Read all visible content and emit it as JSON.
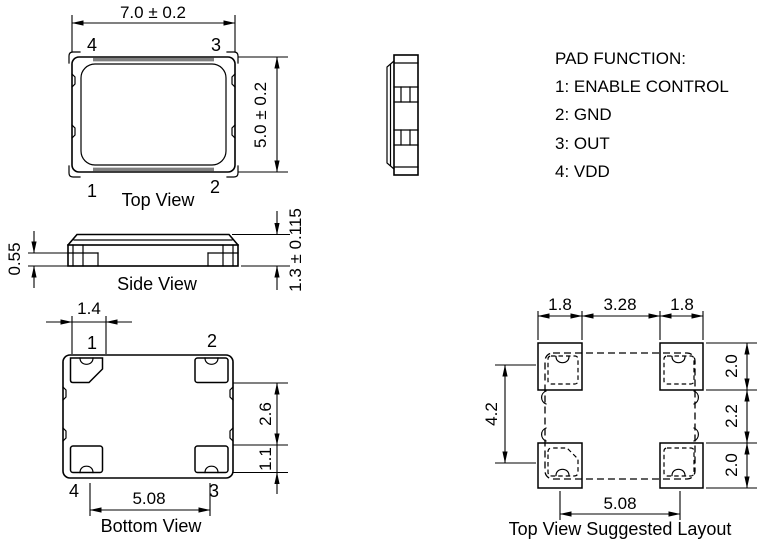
{
  "drawing": {
    "top_view": {
      "title": "Top View",
      "dim_width": "7.0 ± 0.2",
      "dim_height": "5.0 ± 0.2",
      "pin1": "1",
      "pin2": "2",
      "pin3": "3",
      "pin4": "4"
    },
    "side_view": {
      "title": "Side View",
      "dim_seat_height": "0.55",
      "dim_total_height": "1.3 ± 0.115"
    },
    "bottom_view": {
      "title": "Bottom View",
      "dim_pad_width": "1.4",
      "dim_edge_upper": "2.6",
      "dim_edge_lower": "1.1",
      "dim_pad_pitch": "5.08",
      "pin1": "1",
      "pin2": "2",
      "pin3": "3",
      "pin4": "4"
    },
    "pad_function": {
      "title": "PAD FUNCTION:",
      "pin1": "1: ENABLE CONTROL",
      "pin2": "2: GND",
      "pin3": "3: OUT",
      "pin4": "4: VDD"
    },
    "suggested_layout": {
      "title": "Top View Suggested Layout",
      "dim_pad_left": "1.8",
      "dim_gap": "3.28",
      "dim_pad_right": "1.8",
      "dim_col_top": "2.0",
      "dim_col_middle": "2.2",
      "dim_col_bottom": "2.0",
      "dim_vertical_pitch": "4.2",
      "dim_horizontal_pitch": "5.08"
    }
  },
  "colors": {
    "line": "#000000",
    "background": "#ffffff",
    "lid_shade": "#808080"
  }
}
